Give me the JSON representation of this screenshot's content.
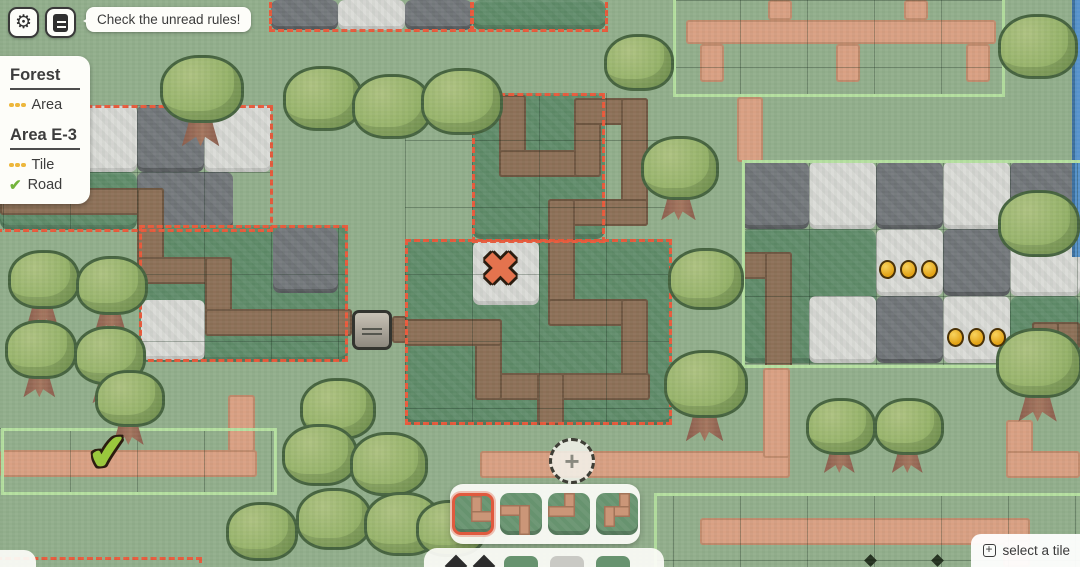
{
  "topbar": {
    "tooltip": "Check the unread rules!"
  },
  "rules_panel": {
    "sections": [
      {
        "title": "Forest",
        "items": [
          {
            "icon": "dots",
            "label": "Area"
          }
        ]
      },
      {
        "title": "Area E-3",
        "items": [
          {
            "icon": "dots",
            "label": "Tile"
          },
          {
            "icon": "check",
            "label": "Road"
          }
        ]
      }
    ]
  },
  "tile_selector": {
    "tiles": [
      {
        "name": "road-top-right",
        "selected": true,
        "segs": [
          [
            16,
            0,
            11,
            26
          ],
          [
            16,
            15,
            26,
            11
          ]
        ]
      },
      {
        "name": "road-left-bottom",
        "selected": false,
        "segs": [
          [
            0,
            12,
            30,
            11
          ],
          [
            19,
            12,
            11,
            30
          ]
        ]
      },
      {
        "name": "road-top-left",
        "selected": false,
        "segs": [
          [
            16,
            0,
            11,
            24
          ],
          [
            0,
            13,
            27,
            11
          ]
        ]
      },
      {
        "name": "road-top-hook",
        "selected": false,
        "segs": [
          [
            23,
            0,
            11,
            24
          ],
          [
            8,
            13,
            26,
            11
          ],
          [
            8,
            13,
            11,
            21
          ]
        ]
      }
    ]
  },
  "hint": {
    "label": "select a tile"
  },
  "palette": {
    "accent_red": "#e8593b",
    "area_green": "#b5e0a0",
    "coin_gold": "#e2a215",
    "grass_light": "#92ae8c",
    "grass_dark": "#5e8a68",
    "road_pink": "#d9a083",
    "road_brown": "#8d7058",
    "water_blue": "#5793cc"
  },
  "map": {
    "fills": [
      {
        "t": "dark",
        "x": 271,
        "y": 0,
        "w": 67,
        "h": 30,
        "n": "stone-tile-dark",
        "i": false,
        "c": "c-stoneD"
      },
      {
        "t": "light",
        "x": 338,
        "y": 0,
        "w": 67,
        "h": 30,
        "n": "stone-tile-light",
        "i": false,
        "c": "c-stoneL"
      },
      {
        "t": "dark",
        "x": 405,
        "y": 0,
        "w": 67,
        "h": 30,
        "n": "stone-tile-dark",
        "i": false,
        "c": "c-stoneD"
      },
      {
        "t": "grass",
        "x": 472,
        "y": 0,
        "w": 134,
        "h": 30,
        "n": "area-grass",
        "i": true,
        "c": "c-dark"
      },
      {
        "t": "light",
        "x": 0,
        "y": 105,
        "w": 137,
        "h": 67,
        "n": "stone-tile-light",
        "i": false,
        "c": "c-stoneL"
      },
      {
        "t": "dark",
        "x": 137,
        "y": 105,
        "w": 67,
        "h": 67,
        "n": "stone-tile-dark",
        "i": false,
        "c": "c-stoneD"
      },
      {
        "t": "light",
        "x": 204,
        "y": 105,
        "w": 67,
        "h": 67,
        "n": "stone-tile-light",
        "i": false,
        "c": "c-stoneL"
      },
      {
        "t": "grass",
        "x": 0,
        "y": 172,
        "w": 137,
        "h": 58,
        "n": "area-grass",
        "i": true,
        "c": "c-dark"
      },
      {
        "t": "dark",
        "x": 137,
        "y": 172,
        "w": 96,
        "h": 58,
        "n": "stone-tile-dark",
        "i": false,
        "c": "c-stoneD"
      },
      {
        "t": "grass",
        "x": 139,
        "y": 225,
        "w": 209,
        "h": 137,
        "n": "area-grass",
        "i": true,
        "c": "c-dark"
      },
      {
        "t": "light",
        "x": 141,
        "y": 300,
        "w": 64,
        "h": 60,
        "n": "stone-tile-light",
        "i": false,
        "c": "c-stoneL"
      },
      {
        "t": "dark",
        "x": 273,
        "y": 228,
        "w": 65,
        "h": 65,
        "n": "stone-tile-dark",
        "i": false,
        "c": "c-stoneD"
      },
      {
        "t": "grass",
        "x": 472,
        "y": 93,
        "w": 133,
        "h": 146,
        "n": "area-grass",
        "i": true,
        "c": "c-dark"
      },
      {
        "t": "grass",
        "x": 405,
        "y": 239,
        "w": 267,
        "h": 186,
        "n": "area-grass",
        "i": true,
        "c": "c-dark"
      },
      {
        "t": "light",
        "x": 473,
        "y": 241,
        "w": 66,
        "h": 64,
        "n": "x-goal-tile",
        "i": true,
        "c": "c-stoneL"
      },
      {
        "t": "grass",
        "x": 742,
        "y": 229,
        "w": 134,
        "h": 134,
        "n": "area-grass",
        "i": true,
        "c": "c-dark"
      },
      {
        "t": "dark",
        "x": 742,
        "y": 162,
        "w": 67,
        "h": 67,
        "n": "stone-tile-dark",
        "i": false,
        "c": "c-stoneD"
      },
      {
        "t": "light",
        "x": 809,
        "y": 162,
        "w": 67,
        "h": 67,
        "n": "stone-tile-light",
        "i": false,
        "c": "c-stoneL"
      },
      {
        "t": "dark",
        "x": 876,
        "y": 162,
        "w": 67,
        "h": 67,
        "n": "stone-tile-dark",
        "i": false,
        "c": "c-stoneD"
      },
      {
        "t": "light",
        "x": 943,
        "y": 162,
        "w": 67,
        "h": 67,
        "n": "stone-tile-light",
        "i": false,
        "c": "c-stoneL"
      },
      {
        "t": "dark",
        "x": 1010,
        "y": 162,
        "w": 70,
        "h": 67,
        "n": "stone-tile-dark",
        "i": false,
        "c": "c-stoneD"
      },
      {
        "t": "light",
        "x": 876,
        "y": 229,
        "w": 67,
        "h": 67,
        "n": "stone-tile-light",
        "i": false,
        "c": "c-stoneL"
      },
      {
        "t": "dark",
        "x": 943,
        "y": 229,
        "w": 67,
        "h": 67,
        "n": "stone-tile-dark",
        "i": false,
        "c": "c-stoneD"
      },
      {
        "t": "light",
        "x": 1010,
        "y": 229,
        "w": 70,
        "h": 67,
        "n": "stone-tile-light",
        "i": false,
        "c": "c-stoneL"
      },
      {
        "t": "light",
        "x": 809,
        "y": 296,
        "w": 67,
        "h": 67,
        "n": "stone-tile-light",
        "i": false,
        "c": "c-stoneL"
      },
      {
        "t": "dark",
        "x": 876,
        "y": 296,
        "w": 67,
        "h": 67,
        "n": "stone-tile-dark",
        "i": false,
        "c": "c-stoneD"
      },
      {
        "t": "light",
        "x": 943,
        "y": 296,
        "w": 67,
        "h": 67,
        "n": "stone-tile-light",
        "i": false,
        "c": "c-stoneL"
      },
      {
        "t": "grass",
        "x": 1010,
        "y": 296,
        "w": 70,
        "h": 72,
        "n": "area-grass",
        "i": true,
        "c": "c-dark"
      },
      {
        "t": "water",
        "x": 1072,
        "y": 0,
        "w": 8,
        "h": 257,
        "n": "water-strip",
        "i": false,
        "c": "c-water"
      }
    ],
    "roads": [
      {
        "c": "r-pink",
        "x": 686,
        "y": 20,
        "w": 310,
        "h": 24
      },
      {
        "c": "r-pink",
        "x": 700,
        "y": 44,
        "w": 24,
        "h": 38
      },
      {
        "c": "r-pink",
        "x": 836,
        "y": 44,
        "w": 24,
        "h": 38
      },
      {
        "c": "r-pink",
        "x": 966,
        "y": 44,
        "w": 24,
        "h": 38
      },
      {
        "c": "r-pink",
        "x": 768,
        "y": 0,
        "w": 24,
        "h": 20
      },
      {
        "c": "r-pink",
        "x": 904,
        "y": 0,
        "w": 24,
        "h": 20
      },
      {
        "c": "r-pink",
        "x": 737,
        "y": 97,
        "w": 26,
        "h": 65
      },
      {
        "c": "r-pink",
        "x": 0,
        "y": 450,
        "w": 257,
        "h": 27
      },
      {
        "c": "r-pink",
        "x": 228,
        "y": 395,
        "w": 27,
        "h": 57
      },
      {
        "c": "r-pink",
        "x": 480,
        "y": 451,
        "w": 310,
        "h": 27
      },
      {
        "c": "r-pink",
        "x": 763,
        "y": 368,
        "w": 27,
        "h": 90
      },
      {
        "c": "r-pink",
        "x": 1006,
        "y": 420,
        "w": 27,
        "h": 58
      },
      {
        "c": "r-pink",
        "x": 1006,
        "y": 451,
        "w": 74,
        "h": 27
      },
      {
        "c": "r-pink",
        "x": 700,
        "y": 518,
        "w": 330,
        "h": 27
      },
      {
        "c": "r-pink",
        "x": 1003,
        "y": 540,
        "w": 27,
        "h": 27
      },
      {
        "c": "r-brown",
        "x": 0,
        "y": 188,
        "w": 164,
        "h": 27
      },
      {
        "c": "r-brown",
        "x": 137,
        "y": 188,
        "w": 27,
        "h": 96
      },
      {
        "c": "r-brown",
        "x": 137,
        "y": 257,
        "w": 95,
        "h": 27
      },
      {
        "c": "r-brown",
        "x": 205,
        "y": 257,
        "w": 27,
        "h": 79
      },
      {
        "c": "r-brown",
        "x": 205,
        "y": 309,
        "w": 147,
        "h": 27
      },
      {
        "c": "r-brown",
        "x": 392,
        "y": 316,
        "w": 15,
        "h": 27
      },
      {
        "c": "r-brown",
        "x": 499,
        "y": 95,
        "w": 27,
        "h": 82
      },
      {
        "c": "r-brown",
        "x": 499,
        "y": 150,
        "w": 102,
        "h": 27
      },
      {
        "c": "r-brown",
        "x": 574,
        "y": 98,
        "w": 27,
        "h": 79
      },
      {
        "c": "r-brown",
        "x": 574,
        "y": 98,
        "w": 74,
        "h": 27
      },
      {
        "c": "r-brown",
        "x": 621,
        "y": 98,
        "w": 27,
        "h": 128
      },
      {
        "c": "r-brown",
        "x": 548,
        "y": 199,
        "w": 100,
        "h": 27
      },
      {
        "c": "r-brown",
        "x": 548,
        "y": 199,
        "w": 27,
        "h": 127
      },
      {
        "c": "r-brown",
        "x": 548,
        "y": 299,
        "w": 100,
        "h": 27
      },
      {
        "c": "r-brown",
        "x": 621,
        "y": 299,
        "w": 27,
        "h": 100
      },
      {
        "c": "r-brown",
        "x": 475,
        "y": 373,
        "w": 175,
        "h": 27
      },
      {
        "c": "r-brown",
        "x": 475,
        "y": 319,
        "w": 27,
        "h": 81
      },
      {
        "c": "r-brown",
        "x": 405,
        "y": 319,
        "w": 97,
        "h": 27
      },
      {
        "c": "r-brown",
        "x": 537,
        "y": 373,
        "w": 27,
        "h": 52
      },
      {
        "c": "r-brown",
        "x": 742,
        "y": 252,
        "w": 50,
        "h": 27
      },
      {
        "c": "r-brown",
        "x": 765,
        "y": 252,
        "w": 27,
        "h": 116
      },
      {
        "c": "r-brown",
        "x": 1032,
        "y": 322,
        "w": 48,
        "h": 27
      },
      {
        "c": "r-brown",
        "x": 1032,
        "y": 322,
        "w": 27,
        "h": 46
      }
    ],
    "grids": [
      {
        "x": 673,
        "y": 0,
        "w": 332,
        "h": 97,
        "px": 0,
        "py": 0
      },
      {
        "x": 742,
        "y": 162,
        "w": 338,
        "h": 206,
        "px": 0,
        "py": 0
      },
      {
        "x": 0,
        "y": 428,
        "w": 277,
        "h": 67,
        "px": -64,
        "py": 0
      },
      {
        "x": 654,
        "y": 493,
        "w": 426,
        "h": 74,
        "px": -48,
        "py": 0
      },
      {
        "x": 405,
        "y": 93,
        "w": 267,
        "h": 332,
        "px": 0,
        "py": -20
      },
      {
        "x": 0,
        "y": 105,
        "w": 271,
        "h": 125,
        "px": -64,
        "py": 0
      },
      {
        "x": 139,
        "y": 225,
        "w": 209,
        "h": 137,
        "px": -2,
        "py": -18
      }
    ],
    "borders": [
      {
        "s": "rb-dash",
        "x": 269,
        "y": -6,
        "w": 205,
        "h": 38
      },
      {
        "s": "rb-dash",
        "x": 470,
        "y": -6,
        "w": 138,
        "h": 38
      },
      {
        "s": "rb-dash",
        "x": -4,
        "y": 105,
        "w": 277,
        "h": 127
      },
      {
        "s": "rb-dash",
        "x": 139,
        "y": 225,
        "w": 209,
        "h": 137
      },
      {
        "s": "rb-dash",
        "x": 472,
        "y": 93,
        "w": 133,
        "h": 150
      },
      {
        "s": "rb-dash",
        "x": 405,
        "y": 239,
        "w": 267,
        "h": 186
      },
      {
        "s": "rb-dash",
        "x": -4,
        "y": 557,
        "w": 206,
        "h": 18
      },
      {
        "s": "rb-green",
        "x": 673,
        "y": -8,
        "w": 332,
        "h": 105
      },
      {
        "s": "rb-green",
        "x": 742,
        "y": 160,
        "w": 344,
        "h": 208
      },
      {
        "s": "rb-green",
        "x": 1,
        "y": 428,
        "w": 276,
        "h": 67
      },
      {
        "s": "rb-green",
        "x": 654,
        "y": 493,
        "w": 432,
        "h": 80
      }
    ],
    "trees": [
      {
        "x": 160,
        "y": 55,
        "s": 78,
        "trunk": true
      },
      {
        "x": 283,
        "y": 66,
        "s": 74,
        "trunk": false
      },
      {
        "x": 352,
        "y": 74,
        "s": 74,
        "trunk": false
      },
      {
        "x": 421,
        "y": 68,
        "s": 76,
        "trunk": false
      },
      {
        "x": 604,
        "y": 34,
        "s": 64,
        "trunk": false
      },
      {
        "x": 641,
        "y": 136,
        "s": 72,
        "trunk": true
      },
      {
        "x": 668,
        "y": 248,
        "s": 70,
        "trunk": false
      },
      {
        "x": 664,
        "y": 350,
        "s": 78,
        "trunk": true
      },
      {
        "x": 8,
        "y": 250,
        "s": 66,
        "trunk": true
      },
      {
        "x": 76,
        "y": 256,
        "s": 66,
        "trunk": true
      },
      {
        "x": 5,
        "y": 320,
        "s": 66,
        "trunk": true
      },
      {
        "x": 74,
        "y": 326,
        "s": 66,
        "trunk": true
      },
      {
        "x": 95,
        "y": 370,
        "s": 64,
        "trunk": true
      },
      {
        "x": 300,
        "y": 378,
        "s": 70,
        "trunk": true
      },
      {
        "x": 282,
        "y": 424,
        "s": 70,
        "trunk": false
      },
      {
        "x": 350,
        "y": 432,
        "s": 72,
        "trunk": false
      },
      {
        "x": 296,
        "y": 488,
        "s": 70,
        "trunk": false
      },
      {
        "x": 364,
        "y": 492,
        "s": 72,
        "trunk": false
      },
      {
        "x": 226,
        "y": 502,
        "s": 66,
        "trunk": false
      },
      {
        "x": 416,
        "y": 500,
        "s": 64,
        "trunk": false
      },
      {
        "x": 998,
        "y": 14,
        "s": 74,
        "trunk": false
      },
      {
        "x": 998,
        "y": 190,
        "s": 76,
        "trunk": false
      },
      {
        "x": 996,
        "y": 328,
        "s": 80,
        "trunk": true
      },
      {
        "x": 806,
        "y": 398,
        "s": 64,
        "trunk": true
      },
      {
        "x": 874,
        "y": 398,
        "s": 64,
        "trunk": true
      }
    ],
    "markers": [
      {
        "type": "x",
        "x": 482,
        "y": 248
      },
      {
        "type": "check",
        "x": 88,
        "y": 430
      },
      {
        "type": "coins",
        "x": 879,
        "y": 260
      },
      {
        "type": "coins",
        "x": 947,
        "y": 328
      },
      {
        "type": "sign",
        "x": 352,
        "y": 310
      },
      {
        "type": "plus",
        "x": 549,
        "y": 438
      },
      {
        "type": "diamond",
        "x": 866,
        "y": 556
      },
      {
        "type": "diamond",
        "x": 933,
        "y": 556
      }
    ]
  }
}
